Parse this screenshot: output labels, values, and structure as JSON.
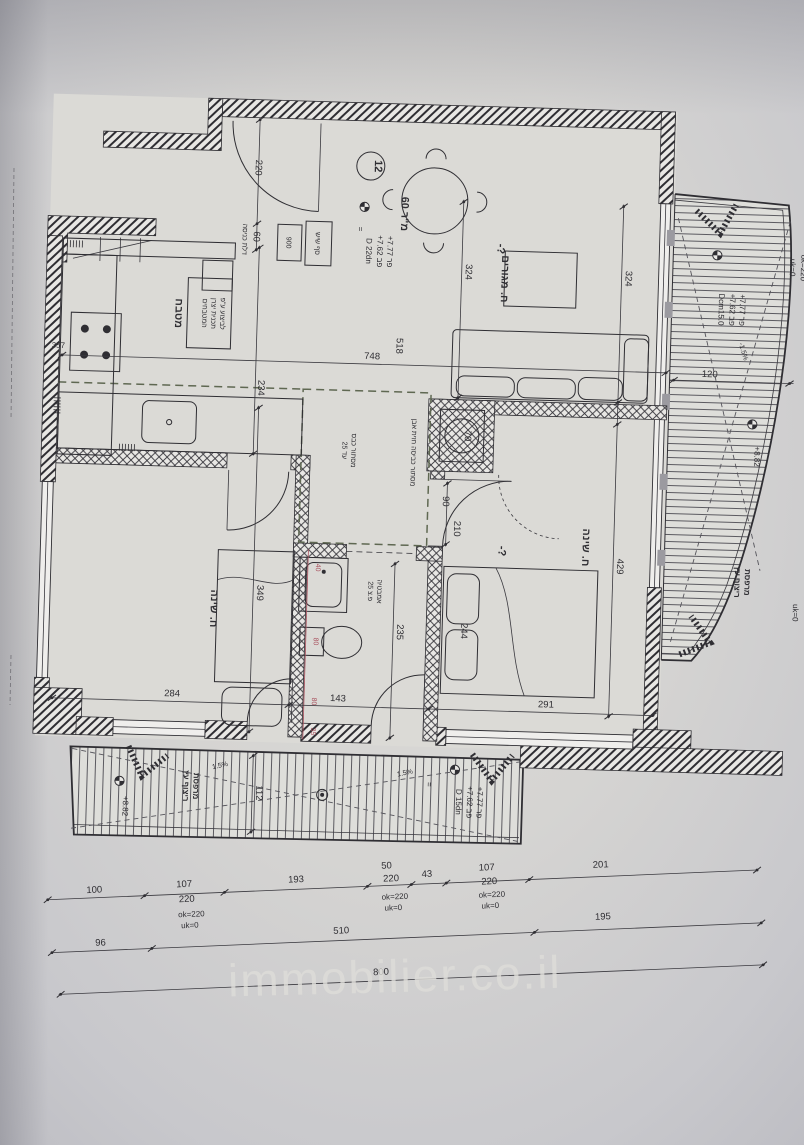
{
  "document": {
    "type": "apartment floor plan photo",
    "ink_color": "#2f2e33",
    "plumbing_color": "#a84f5c",
    "paper_color": "#cdccd0",
    "watermark": "immobilier.co.il"
  },
  "labels": {
    "unit_number": "12",
    "unit_area": "60 מ\"ר",
    "living": "ח. מגורים",
    "living_q": "-?",
    "kitchen": "מטבח",
    "kitchen_note1": "לביצוע ע\"פ",
    "kitchen_note2": "תכנית יצרן",
    "kitchen_note3": "המטבחים",
    "bedroom": "ח. שינה",
    "bedroom_q": "-?",
    "bath1": "אמבטיה",
    "bath2": "פ.צ 25",
    "laundry1": "מסתור כבס",
    "laundry2": "עד 25",
    "shaft_note": "מסתור כביסה חזית אבן",
    "shaft_size": "70",
    "balcony1": "מרפסת",
    "balcony2": "ריצוף עץ",
    "entry_box_a": "900",
    "entry_box_b": "סף שיש",
    "entry_door": "דלת כניסה"
  },
  "levels": {
    "fr": "+7.77 פר",
    "fb": "+7.62 פב",
    "d22": "D 22dn",
    "dcm15": "Dcm15.0",
    "d15": "D 15dn",
    "p882": "+8.82",
    "ok220": "ok=220",
    "uk0": "uk=0",
    "slope": "1.5%",
    "slope_neg": "-1.5%",
    "eq": "="
  },
  "dims": {
    "a220": "220",
    "a60": "60",
    "a324": "324",
    "a234": "234",
    "a357": "357",
    "a748": "748",
    "a518": "518",
    "a120": "120",
    "a429": "429",
    "a349": "349",
    "a284": "284",
    "a235": "235",
    "a143": "143",
    "a291": "291",
    "a244": "244",
    "a90": "90",
    "a210": "210",
    "a112": "112",
    "r40": "40",
    "r80": "80",
    "r35": "35"
  },
  "dim_rows": {
    "r1": [
      "100",
      "107",
      "220",
      "193",
      "50",
      "220",
      "43",
      "107",
      "220",
      "201"
    ],
    "r2": [
      "96",
      "510",
      "195"
    ],
    "r3": [
      "800"
    ]
  }
}
